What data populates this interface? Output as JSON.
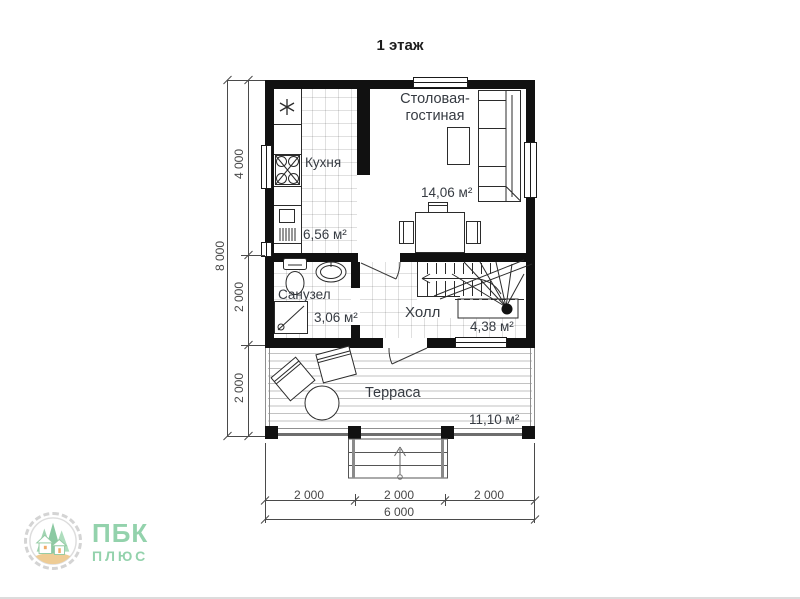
{
  "title": "1 этаж",
  "rooms": {
    "kitchen": {
      "label": "Кухня",
      "area": "6,56 м²"
    },
    "living": {
      "label_line1": "Столовая-",
      "label_line2": "гостиная",
      "area": "14,06 м²"
    },
    "bathroom": {
      "label": "Санузел",
      "area": "3,06 м²"
    },
    "hall": {
      "label": "Холл",
      "area": "4,38 м²"
    },
    "terrace": {
      "label": "Терраса",
      "area": "11,10 м²"
    }
  },
  "dimensions": {
    "left_total": "8 000",
    "left_segments": [
      "4 000",
      "2 000",
      "2 000"
    ],
    "bottom_segments": [
      "2 000",
      "2 000",
      "2 000"
    ],
    "bottom_total": "6 000"
  },
  "logo": {
    "title": "ПБК",
    "subtitle": "ПЛЮС"
  },
  "colors": {
    "wall": "#111111",
    "linework": "#2b2b2b",
    "dimension": "#4a4a4a",
    "label_text": "#363b42",
    "logo_green": "#8ed0a8",
    "logo_sand": "#eeca90"
  }
}
